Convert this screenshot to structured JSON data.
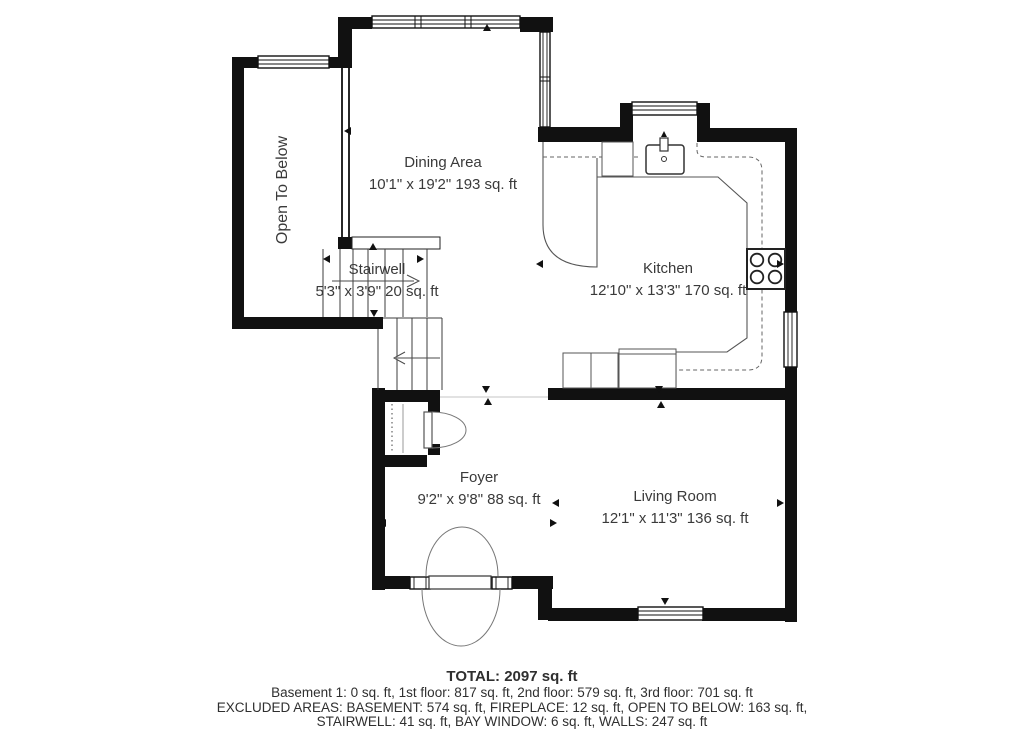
{
  "rooms": {
    "open_to_below": {
      "name": "Open To Below"
    },
    "dining": {
      "name": "Dining Area",
      "dims": "10'1\" x 19'2\" 193 sq. ft"
    },
    "stairwell": {
      "name": "Stairwell",
      "dims": "5'3\" x 3'9\" 20 sq. ft"
    },
    "kitchen": {
      "name": "Kitchen",
      "dims": "12'10\" x 13'3\" 170 sq. ft"
    },
    "foyer": {
      "name": "Foyer",
      "dims": "9'2\" x 9'8\" 88 sq. ft"
    },
    "living": {
      "name": "Living Room",
      "dims": "12'1\" x 11'3\" 136 sq. ft"
    }
  },
  "summary": {
    "total": "TOTAL: 2097 sq. ft",
    "floors": "Basement 1: 0 sq. ft, 1st floor: 817 sq. ft, 2nd floor: 579 sq. ft, 3rd floor: 701 sq. ft",
    "excluded_line1": "EXCLUDED AREAS: BASEMENT: 574 sq. ft, FIREPLACE: 12 sq. ft, OPEN TO BELOW: 163 sq. ft,",
    "excluded_line2": "STAIRWELL: 41 sq. ft, BAY WINDOW: 6 sq. ft, WALLS: 247 sq. ft"
  },
  "colors": {
    "wall": "#111111",
    "thin_line": "#3c3c3c",
    "counter_line": "#555555",
    "text": "#3a3a3a",
    "background": "#ffffff"
  }
}
